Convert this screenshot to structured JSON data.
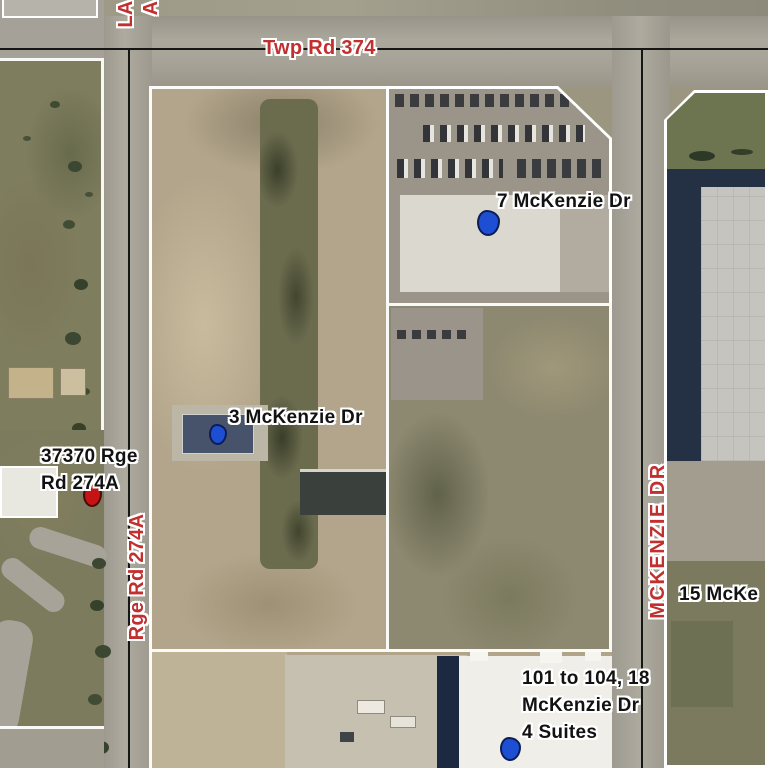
{
  "map": {
    "description": "Aerial parcel map of McKenzie Drive industrial area",
    "colors": {
      "road_label": "#c22f2f",
      "address_label": "#121212",
      "halo": "#ffffff"
    },
    "road_labels": {
      "twp": "Twp Rd 374",
      "rge": "Rge Rd 274A",
      "mckenzie": "MCKENZIE DR",
      "partial_line1": "LA",
      "partial_line2": "A"
    },
    "address_labels": {
      "seven": "7 McKenzie Dr",
      "three": "3 McKenzie Dr",
      "rge37370_line1": "37370 Rge",
      "rge37370_line2": "Rd 274A",
      "fifteen_partial": "15 McKe",
      "suites_line1": "101 to 104, 18",
      "suites_line2": "McKenzie Dr",
      "suites_line3": "4 Suites"
    },
    "markers": [
      {
        "id": "7-mckenzie",
        "color": "#1e4fd2",
        "shape": "blob"
      },
      {
        "id": "3-mckenzie",
        "color": "#1e4fd2",
        "shape": "blob"
      },
      {
        "id": "37370-rge-rd-274a",
        "color": "#c41414",
        "shape": "blob"
      },
      {
        "id": "101-104-18-mckenzie",
        "color": "#1e4fd2",
        "shape": "blob"
      }
    ]
  }
}
